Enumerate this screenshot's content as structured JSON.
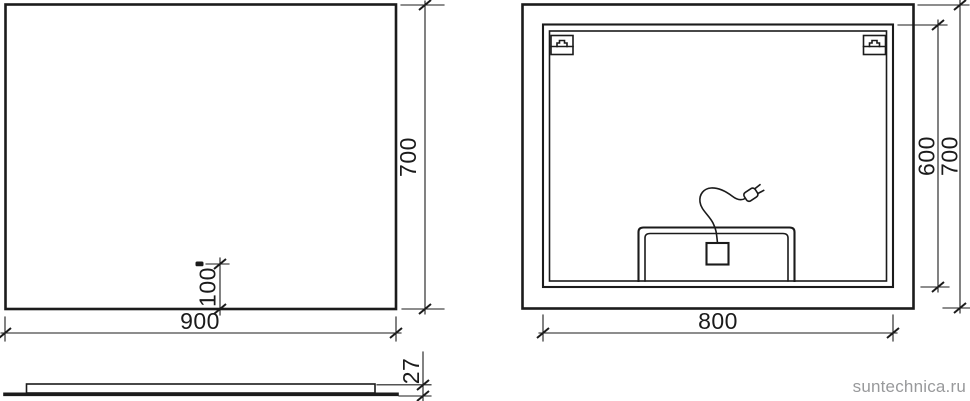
{
  "colors": {
    "line": "#1b1b1b",
    "watermark": "#98999b",
    "background": "#ffffff"
  },
  "watermark": "suntechnica.ru",
  "views": {
    "front": {
      "width_label": "900",
      "height_label": "700",
      "sensor_offset_label": "100"
    },
    "back": {
      "width_label": "800",
      "frame_height_label": "600",
      "height_label": "700"
    },
    "side": {
      "thickness_label": "27"
    }
  }
}
